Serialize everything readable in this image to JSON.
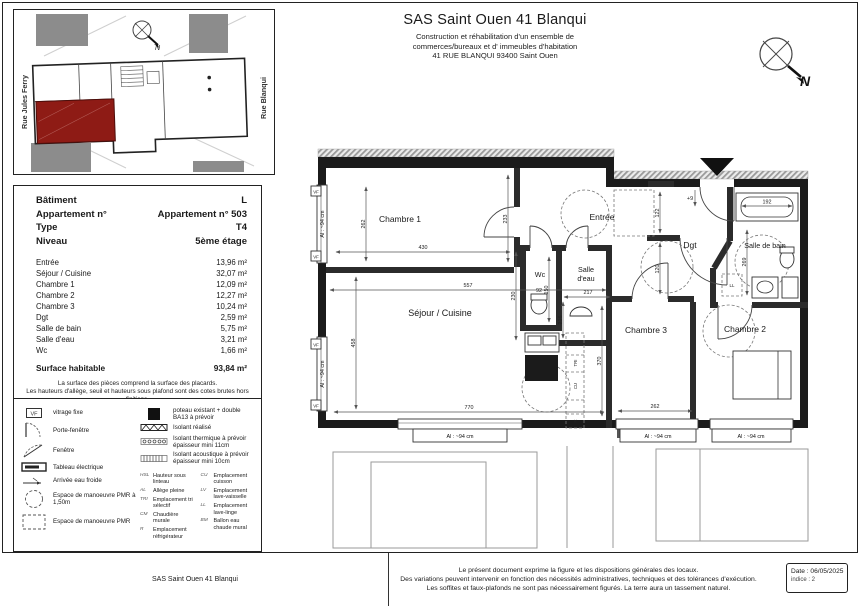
{
  "header": {
    "title": "SAS Saint Ouen 41 Blanqui",
    "line1": "Construction et réhabilitation d'un ensemble de",
    "line2": "commerces/bureaux et d' immeubles d'habitation",
    "line3": "41 RUE BLANQUI  93400 Saint Ouen"
  },
  "site_plan": {
    "street_left": "Rue Jules Ferry",
    "street_right": "Rue Blanqui",
    "north": "N"
  },
  "compass": {
    "north": "N"
  },
  "info": {
    "rows": [
      {
        "label": "Bâtiment",
        "value": "L"
      },
      {
        "label": "Appartement n°",
        "value": "Appartement n° 503"
      },
      {
        "label": "Type",
        "value": "T4"
      },
      {
        "label": "Niveau",
        "value": "5ème étage"
      }
    ],
    "areas": [
      {
        "label": "Entrée",
        "value": "13,96 m²"
      },
      {
        "label": "Séjour / Cuisine",
        "value": "32,07 m²"
      },
      {
        "label": "Chambre 1",
        "value": "12,09 m²"
      },
      {
        "label": "Chambre 2",
        "value": "12,27 m²"
      },
      {
        "label": "Chambre 3",
        "value": "10,24 m²"
      },
      {
        "label": "Dgt",
        "value": "2,59 m²"
      },
      {
        "label": "Salle de bain",
        "value": "5,75 m²"
      },
      {
        "label": "Salle d'eau",
        "value": "3,21 m²"
      },
      {
        "label": "Wc",
        "value": "1,66 m²"
      }
    ],
    "total": {
      "label": "Surface habitable",
      "value": "93,84 m²"
    },
    "note1": "La surface des pièces comprend la surface des placards.",
    "note2": "Les hauteurs d'allège, seuil et hauteurs sous plafond sont des cotes brutes hors finitions."
  },
  "legend": {
    "vf": "VF",
    "left": [
      "vitrage fixe",
      "Porte-fenêtre",
      "Fenêtre",
      "Tableau électrique",
      "Arrivée eau froide",
      "Espace de manoeuvre PMR à 1,50m",
      "Espace de manoeuvre PMR"
    ],
    "right": [
      "poteau existant + double BA13 à prévoir",
      "Isolant réalisé",
      "Isolant thermique à prévoir épaisseur mini 11cm",
      "Isolant acoustique à prévoir épaisseur mini 10cm"
    ],
    "abbr": [
      {
        "k": "HSL",
        "v": "Hauteur sous linteau"
      },
      {
        "k": "AL",
        "v": "Allège pleine"
      },
      {
        "k": "TRI",
        "v": "Emplacement tri sélectif"
      },
      {
        "k": "CM",
        "v": "Chaudière murale"
      },
      {
        "k": "R",
        "v": "Emplacement réfrigérateur"
      },
      {
        "k": "CU",
        "v": "Emplacement cuisson"
      },
      {
        "k": "LV",
        "v": "Emplacement lave-vaisselle"
      },
      {
        "k": "LL",
        "v": "Emplacement lave-linge"
      },
      {
        "k": "BM",
        "v": "Ballon eau chaude mural"
      }
    ]
  },
  "plan": {
    "vf": "VF",
    "window_label": "Al : ~94 cm",
    "rooms": {
      "chambre1": "Chambre 1",
      "entree": "Entrée",
      "dgt": "Dgt",
      "sdb": "Salle de bain",
      "wc": "Wc",
      "sde1": "Salle",
      "sde2": "d'eau",
      "sejour": "Séjour / Cuisine",
      "chambre3": "Chambre 3",
      "chambre2": "Chambre 2"
    },
    "dims": {
      "d430": "430",
      "d557": "557",
      "d233": "233",
      "d262l": "262",
      "d458": "458",
      "d770": "770",
      "d262b": "262",
      "d370": "370",
      "d122": "122",
      "d120": "120",
      "d150": "150",
      "d92": "92",
      "d230": "230",
      "d217": "217",
      "d216": "216",
      "d192": "192",
      "d269": "269",
      "step": "+9"
    },
    "marks": {
      "tri": "TRI",
      "cu": "CU",
      "r": "R",
      "ll": "LL"
    }
  },
  "footer": {
    "left": "SAS Saint Ouen 41 Blanqui",
    "line1": "Le présent document exprime la figure et les dispositions générales des locaux.",
    "line2": "Des variations peuvent intervenir en fonction des nécessités administratives, techniques et des tolérances d'exécution.",
    "line3": "Les soffites et faux-plafonds ne sont pas nécessairement figurés. La terre aura un tassement naturel.",
    "date": "Date : 06/05/2025",
    "indice": "indice : 2"
  },
  "colors": {
    "unit_red": "#8e1b15",
    "block_gray": "#8c8c8c",
    "wall_black": "#1b1b1b"
  }
}
